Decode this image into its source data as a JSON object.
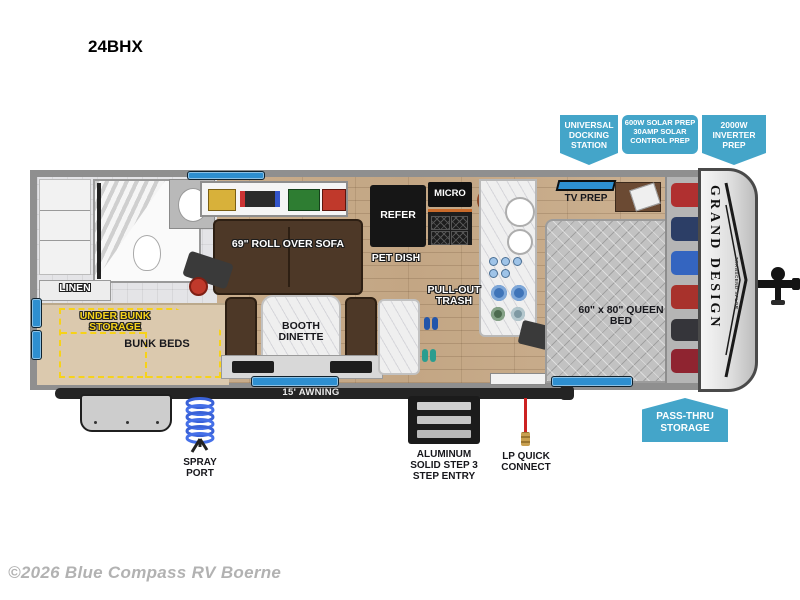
{
  "page": {
    "model": "24BHX",
    "footer": "©2026 Blue Compass RV Boerne"
  },
  "callouts": {
    "docking": "UNIVERSAL DOCKING STATION",
    "solar": "600W SOLAR PREP 30AMP SOLAR CONTROL PREP",
    "inverter": "2000W INVERTER PREP",
    "passthru": "PASS-THRU STORAGE"
  },
  "interior": {
    "linen": "LINEN",
    "under_bunk_storage": "UNDER BUNK STORAGE",
    "bunk_beds": "BUNK BEDS",
    "sofa": "69\" ROLL OVER SOFA",
    "pet_dish": "PET DISH",
    "refer": "REFER",
    "micro": "MICRO",
    "pull_out_trash": "PULL-OUT TRASH",
    "booth_dinette": "BOOTH DINETTE",
    "tv_prep": "TV PREP",
    "queen_bed": "60\" x 80\" QUEEN BED"
  },
  "exterior": {
    "awning": "15' AWNING",
    "spray_port": "SPRAY PORT",
    "steps": "ALUMINUM SOLID STEP 3 STEP ENTRY",
    "lp_quick_connect": "LP QUICK CONNECT"
  },
  "branding": {
    "brand": "GRAND DESIGN",
    "series": "TRANSCEND XPLOR"
  },
  "colors": {
    "callout_blue": "#44a5c9",
    "highlight_yellow": "#f6d21a",
    "window_blue": "#2e8fd0"
  }
}
